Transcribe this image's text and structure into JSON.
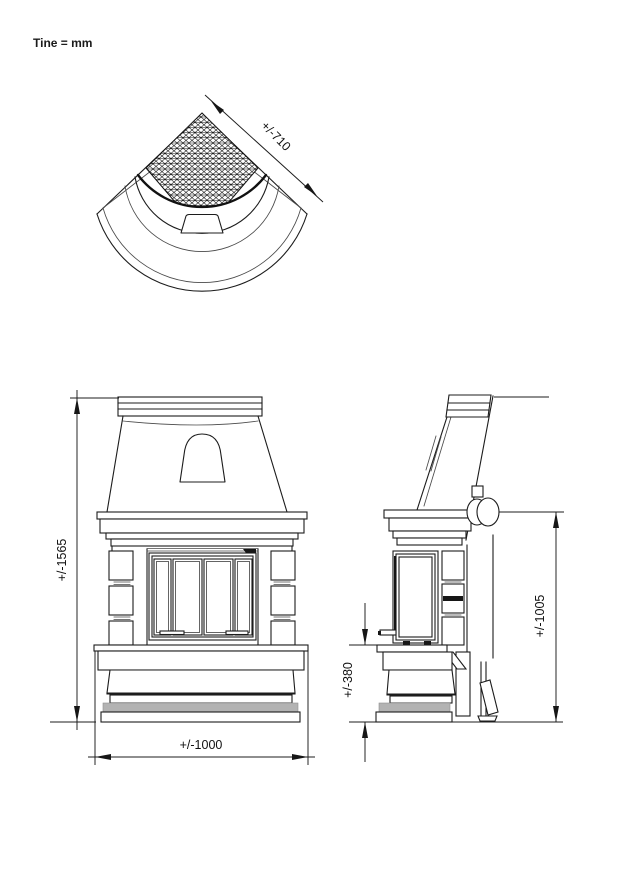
{
  "note": {
    "units_label": "Tine = mm"
  },
  "top_view": {
    "width_dim": "+/-710"
  },
  "front_view": {
    "height_dim": "+/-1565",
    "width_dim": "+/-1000"
  },
  "side_view": {
    "hearth_height_dim": "+/-380",
    "outlet_height_dim": "+/-1005"
  }
}
